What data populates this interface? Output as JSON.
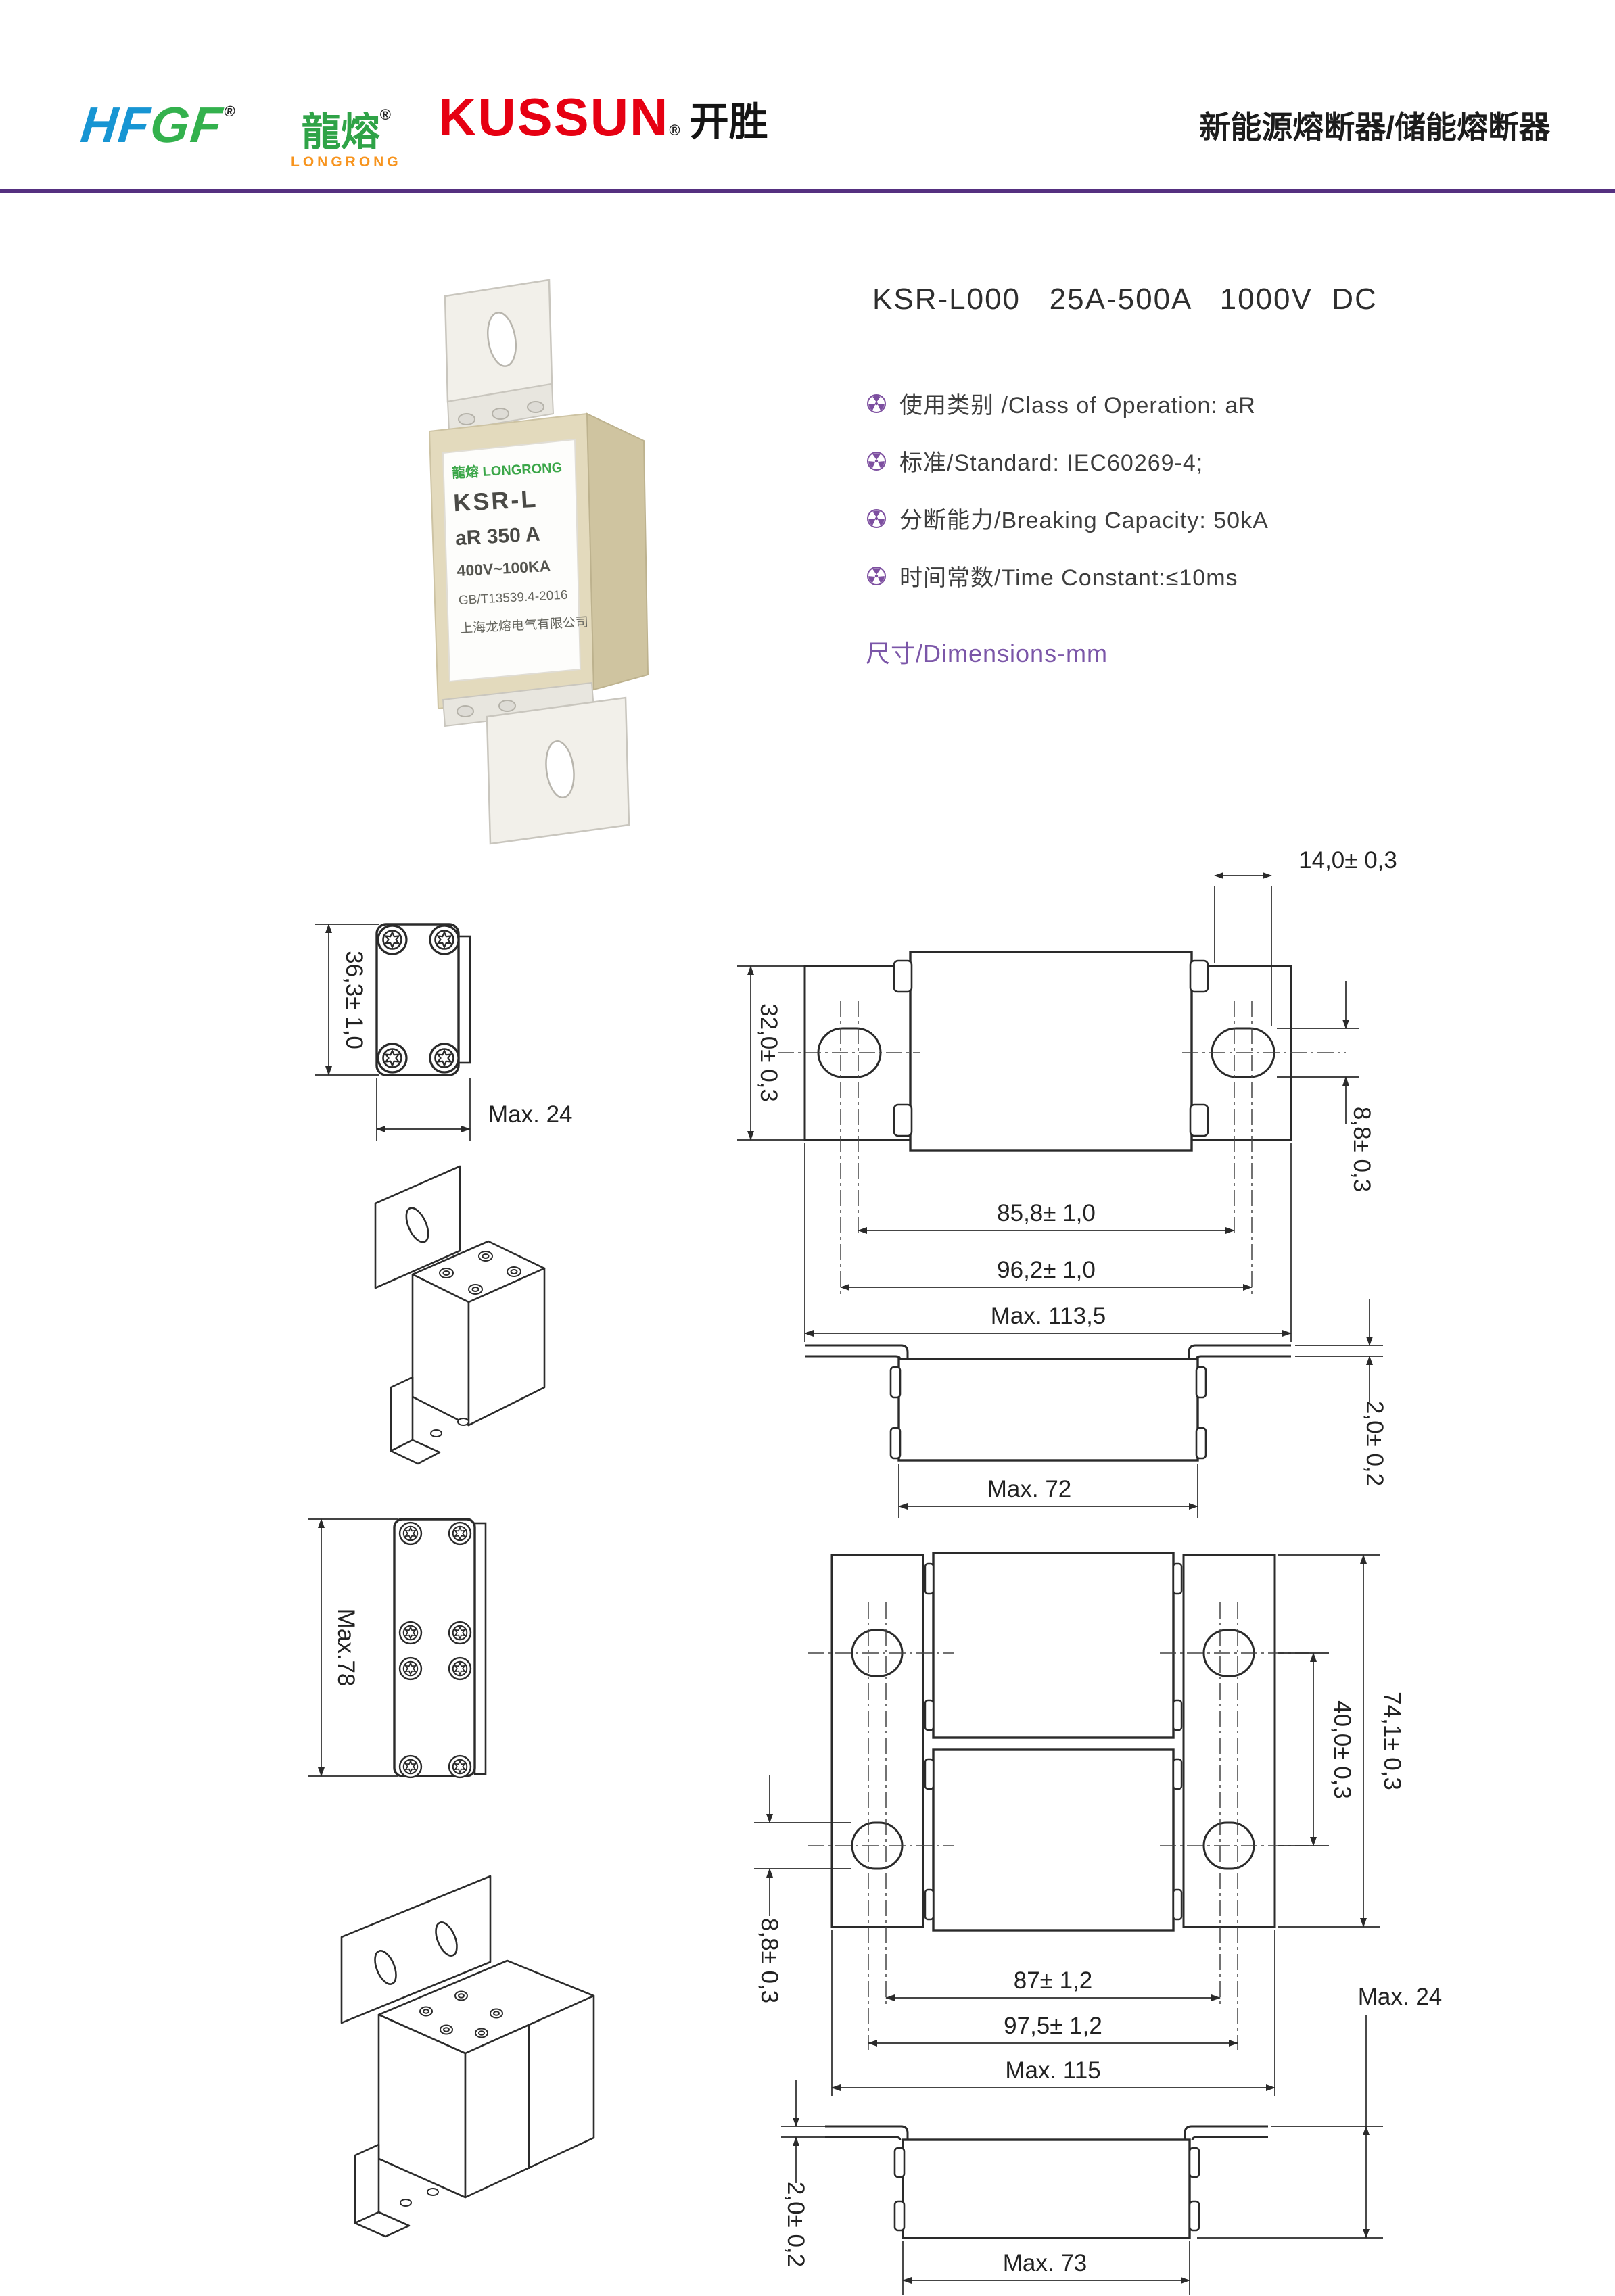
{
  "header": {
    "hfgf": "HFGF",
    "hfgf_reg": "®",
    "longrong": "龍熔",
    "longrong_reg": "®",
    "longrong_sub": "LONGRONG",
    "kussun": "KUSSUN",
    "kussun_reg": "®",
    "kaisheng": "开胜",
    "page_title": "新能源熔断器/储能熔断器"
  },
  "product": {
    "title": "KSR-L000   25A-500A   1000V  DC",
    "specs": [
      "使用类别 /Class of Operation: aR",
      "标准/Standard:  IEC60269-4;",
      "分断能力/Breaking Capacity: 50kA",
      "时间常数/Time Constant:≤10ms"
    ],
    "dimensions_heading": "尺寸/Dimensions-mm",
    "photo_label": {
      "brand": "龍熔 LONGRONG",
      "line1": "KSR-L",
      "line2": "aR 350 A",
      "line3": "400V~100KA",
      "line4": "GB/T13539.4-2016",
      "line5": "上海龙熔电气有限公司"
    }
  },
  "drawings": {
    "small_top": {
      "height": "36,3± 1,0",
      "width": "Max. 24"
    },
    "small_front": {
      "tab_width": "14,0± 0,3",
      "tab_height": "32,0± 0,3",
      "hole_height": "8,8± 0,3",
      "hole_span": "85,8± 1,0",
      "outer_span": "96,2± 1,0",
      "total_width": "Max. 113,5"
    },
    "small_side": {
      "thickness": "2,0± 0,2",
      "body_width": "Max. 72"
    },
    "large_top": {
      "height": "Max.78"
    },
    "large_front": {
      "hole_span": "40,0± 0,3",
      "tab_height": "74,1± 0,3",
      "hole_height": "8,8± 0,3",
      "span1": "87± 1,2",
      "span2": "97,5± 1,2",
      "total_width": "Max. 115"
    },
    "large_side": {
      "height": "Max. 24",
      "thickness": "2,0± 0,2",
      "body_width": "Max. 73"
    }
  }
}
